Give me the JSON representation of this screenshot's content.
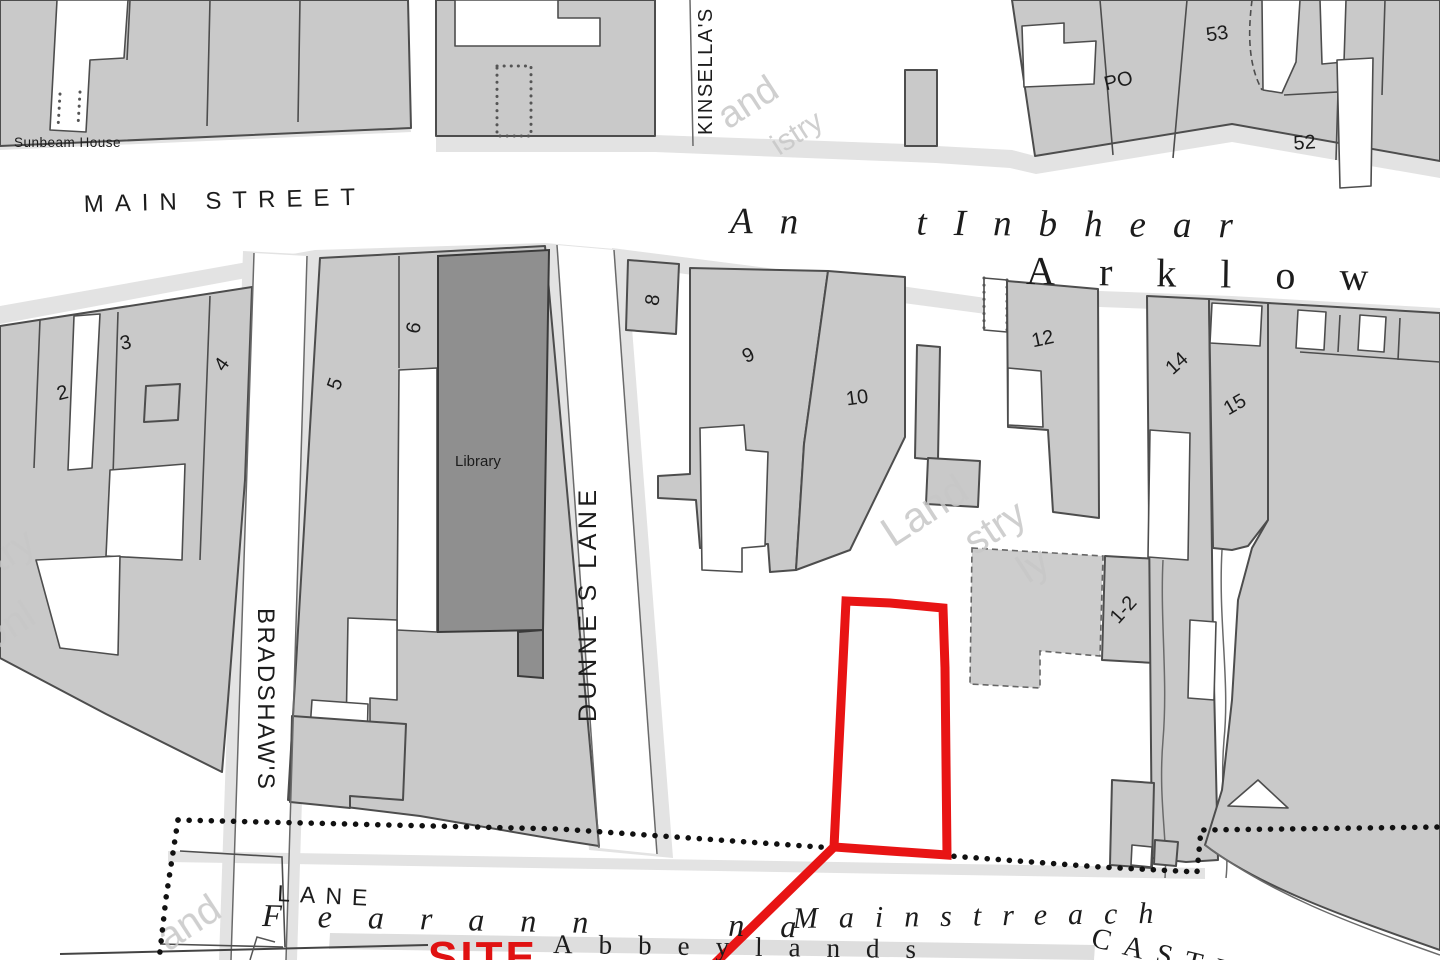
{
  "streets": {
    "main_street": "MAIN STREET",
    "irish_street_name": "An tInbhear",
    "town_name": "Arklow",
    "dunnes_lane": "DUNNE'S LANE",
    "kinsellas_lane": "KINSELLA'S",
    "bradshaws_lane": "BRADSHAW'S",
    "bradshaws_lane_word": "LANE",
    "castle_street": "CASTLE"
  },
  "townland": {
    "irish_part1": "Fearann na",
    "irish_part2": "Mainstreach",
    "english": "Abbeylands"
  },
  "labels": {
    "sunbeam_house": "Sunbeam House",
    "library": "Library",
    "post_office": "PO",
    "site": "SITE"
  },
  "plot_numbers": {
    "p2": "2",
    "p3": "3",
    "p4": "4",
    "p5": "5",
    "p6": "6",
    "p8": "8",
    "p9": "9",
    "p10": "10",
    "p12": "12",
    "p14": "14",
    "p15": "15",
    "p52": "52",
    "p53": "53",
    "p1_2": "1-2"
  },
  "watermark": {
    "phrase": "Land Registry Only",
    "fragments": [
      "and",
      "istry",
      "stry",
      "Onl",
      "Land",
      "stry",
      "ly",
      "and"
    ]
  },
  "colors": {
    "building_fill": "#c9c9c9",
    "building_stroke": "#4d4d4d",
    "library_fill": "#8f8f8f",
    "road_fill": "#e3e3e3",
    "site_outline": "#e81414",
    "site_text": "#e01212",
    "boundary_dots": "#111111",
    "watermark": "#c7c7c7"
  }
}
